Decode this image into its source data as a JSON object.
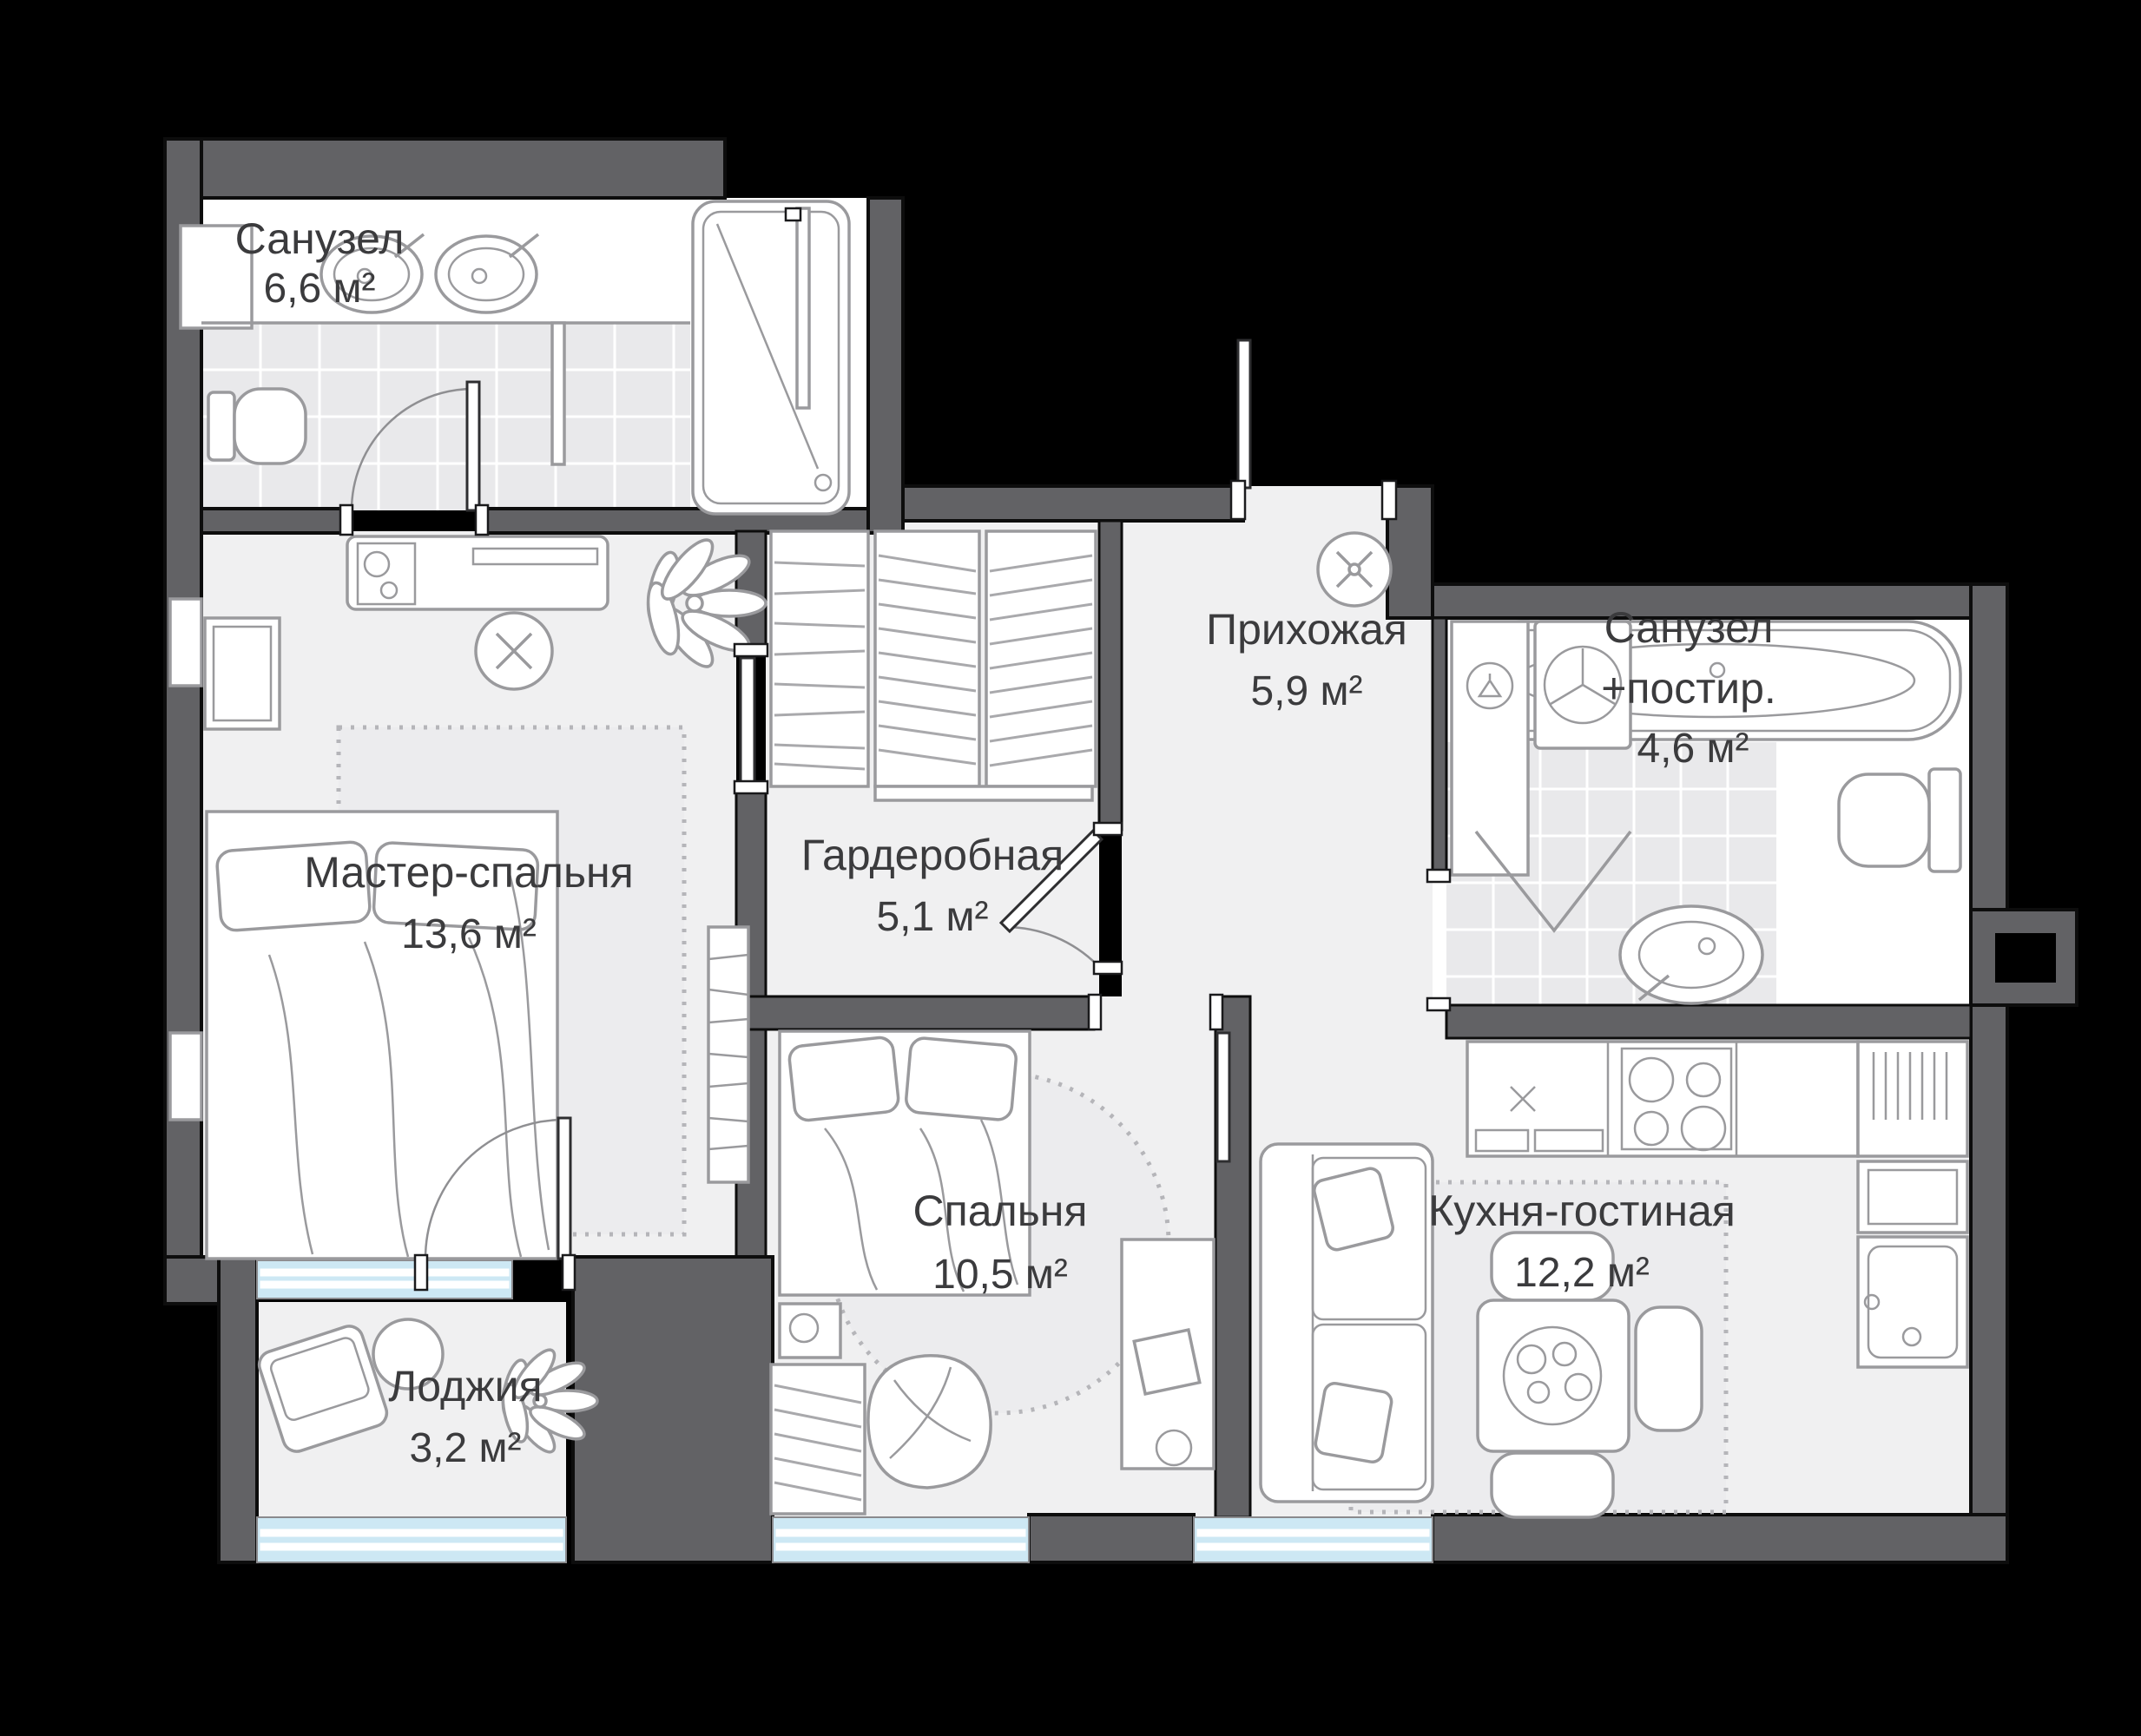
{
  "plan": {
    "type": "apartment-floor-plan",
    "language": "ru",
    "rooms": [
      {
        "id": "bath1",
        "name": "Санузел",
        "area": "6,6 м²"
      },
      {
        "id": "master",
        "name": "Мастер-спальня",
        "area": "13,6 м²"
      },
      {
        "id": "wardrobe",
        "name": "Гардеробная",
        "area": "5,1 м²"
      },
      {
        "id": "hall",
        "name": "Прихожая",
        "area": "5,9 м²"
      },
      {
        "id": "bath2",
        "name": "Санузел",
        "name2": "+постир.",
        "area": "4,6 м²"
      },
      {
        "id": "bedroom",
        "name": "Спальня",
        "area": "10,5 м²"
      },
      {
        "id": "kitchen",
        "name": "Кухня-гостиная",
        "area": "12,2 м²"
      },
      {
        "id": "loggia",
        "name": "Лоджия",
        "area": "3,2 м²"
      }
    ],
    "fixtures": {
      "bath1": [
        "double-sink",
        "toilet",
        "shower-cabin",
        "door"
      ],
      "master": [
        "double-bed",
        "desk",
        "chair",
        "dresser",
        "bookshelf",
        "rug",
        "plant"
      ],
      "wardrobe": [
        "shelving-unit",
        "hanging-rail",
        "hanging-rail",
        "sliding-door"
      ],
      "hall": [
        "ceiling-light",
        "entrance-door"
      ],
      "bath2": [
        "bathtub",
        "toilet",
        "sink",
        "washing-machine",
        "closet-with-hanger",
        "folding-door"
      ],
      "bedroom": [
        "single-bed",
        "nightstand",
        "wardrobe",
        "beanbag",
        "desk",
        "round-rug"
      ],
      "kitchen": [
        "kitchen-counter",
        "stove-4-burners",
        "kitchen-sink",
        "tall-cabinet",
        "dining-table",
        "chairs",
        "sofa",
        "rug"
      ],
      "loggia": [
        "armchair",
        "round-table",
        "plant"
      ]
    },
    "colors": {
      "background": "#000000",
      "wall": "#626265",
      "floor": "#f0f0f1",
      "room": "#ffffff",
      "tile": "#e9e9eb",
      "window": "#cde8f4",
      "furniture_line": "#9a9a9d",
      "label": "#3b3b3d"
    }
  }
}
